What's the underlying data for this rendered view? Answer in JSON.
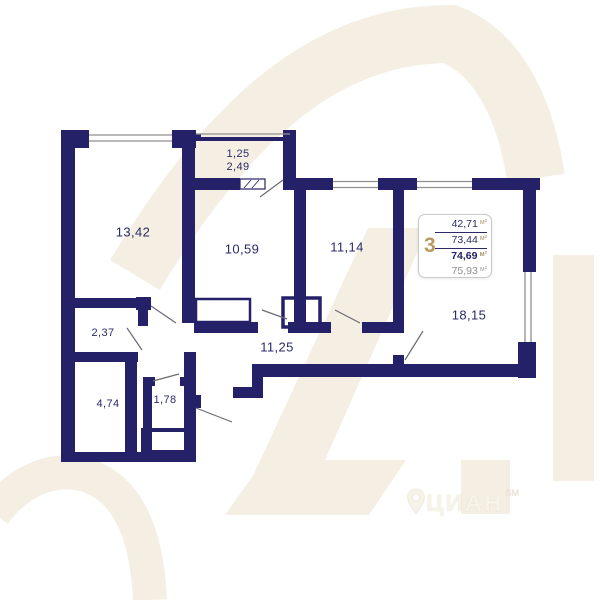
{
  "plan_title": "apartment floor plan",
  "rooms": [
    {
      "name": "room-13",
      "area": "13,42"
    },
    {
      "name": "balcony-top",
      "area": "1,25"
    },
    {
      "name": "balcony",
      "area": "2,49"
    },
    {
      "name": "room-10",
      "area": "10,59"
    },
    {
      "name": "room-11",
      "area": "11,14"
    },
    {
      "name": "hall-2",
      "area": "2,37"
    },
    {
      "name": "room-4",
      "area": "4,74"
    },
    {
      "name": "storage-1",
      "area": "1,78"
    },
    {
      "name": "corridor",
      "area": "11,25"
    },
    {
      "name": "living-18",
      "area": "18,15"
    }
  ],
  "info_box": {
    "rooms_count": "3",
    "areas": [
      {
        "value": "42,71",
        "unit": "м²",
        "style": "regular"
      },
      {
        "value": "73,44",
        "unit": "м²",
        "style": "regular"
      },
      {
        "value": "74,69",
        "unit": "м²",
        "style": "bold"
      },
      {
        "value": "75,93",
        "unit": "м²",
        "style": "muted"
      }
    ]
  },
  "logo": {
    "text": "ЦИАН",
    "superscript": "SM"
  },
  "colors": {
    "wall": "#252168",
    "label": "#2b2a69",
    "accent_gold": "#b79b62",
    "watermark": "#f4efe2",
    "window_line": "#8f8f8f",
    "muted_value": "#8f8f8f"
  }
}
